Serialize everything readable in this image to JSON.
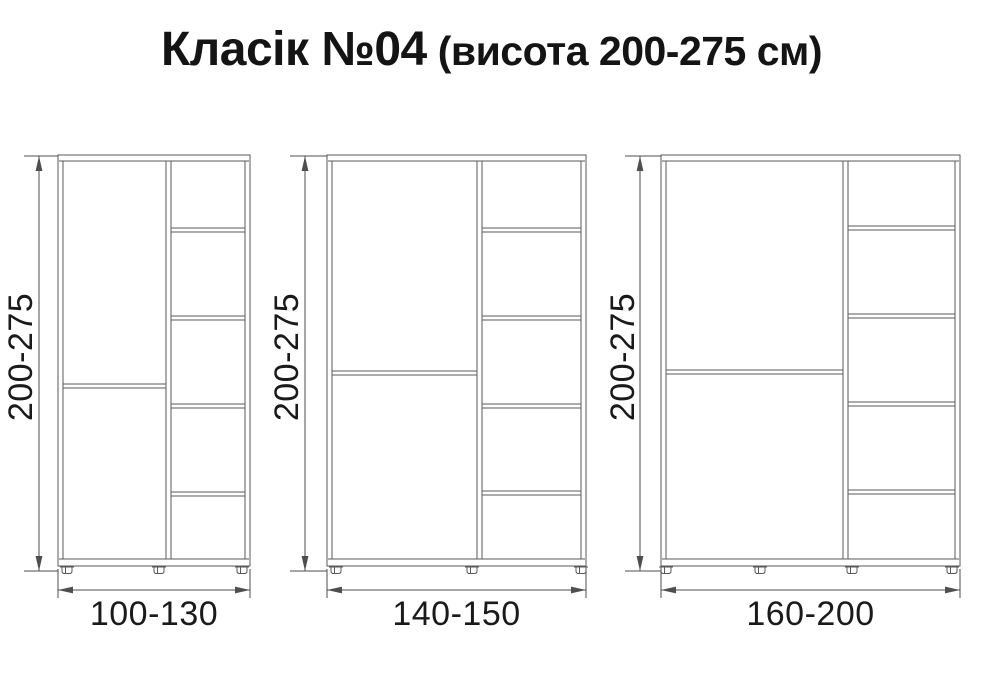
{
  "title": {
    "main": "Класік №04",
    "sub": "(висота 200-275 см)"
  },
  "colors": {
    "cabinet_line": "#585858",
    "dim_line": "#4e4e4e",
    "label_text": "#1a1a1a",
    "background": "#ffffff"
  },
  "diagram": {
    "body_top": 155,
    "body_bottom": 566,
    "base_inner_y": 559,
    "floor_y": 571,
    "panel": 5,
    "top_panel": 6,
    "hdim_y": 590,
    "hlabel_y": 614,
    "vlabel_cy": 357,
    "cabinets": [
      {
        "name": "cabinet-small",
        "height_label": "200-275",
        "width_label": "100-130",
        "left": 58,
        "right": 250,
        "separator_x": 166,
        "door_divider_y": 384,
        "shelf_ys": [
          228,
          316,
          404,
          492
        ],
        "feet_x": [
          67,
          159,
          242
        ],
        "vdim_x": 39,
        "vlabel_cx": 21
      },
      {
        "name": "cabinet-medium",
        "height_label": "200-275",
        "width_label": "140-150",
        "left": 327,
        "right": 586,
        "separator_x": 477,
        "door_divider_y": 371,
        "shelf_ys": [
          228,
          316,
          404,
          491
        ],
        "feet_x": [
          336,
          472,
          581
        ],
        "vdim_x": 305,
        "vlabel_cx": 287
      },
      {
        "name": "cabinet-large",
        "height_label": "200-275",
        "width_label": "160-200",
        "left": 661,
        "right": 960,
        "separator_x": 843,
        "door_divider_y": 370,
        "shelf_ys": [
          226,
          314,
          402,
          490
        ],
        "feet_x": [
          666,
          760,
          852,
          952
        ],
        "vdim_x": 640,
        "vlabel_cx": 623
      }
    ]
  }
}
